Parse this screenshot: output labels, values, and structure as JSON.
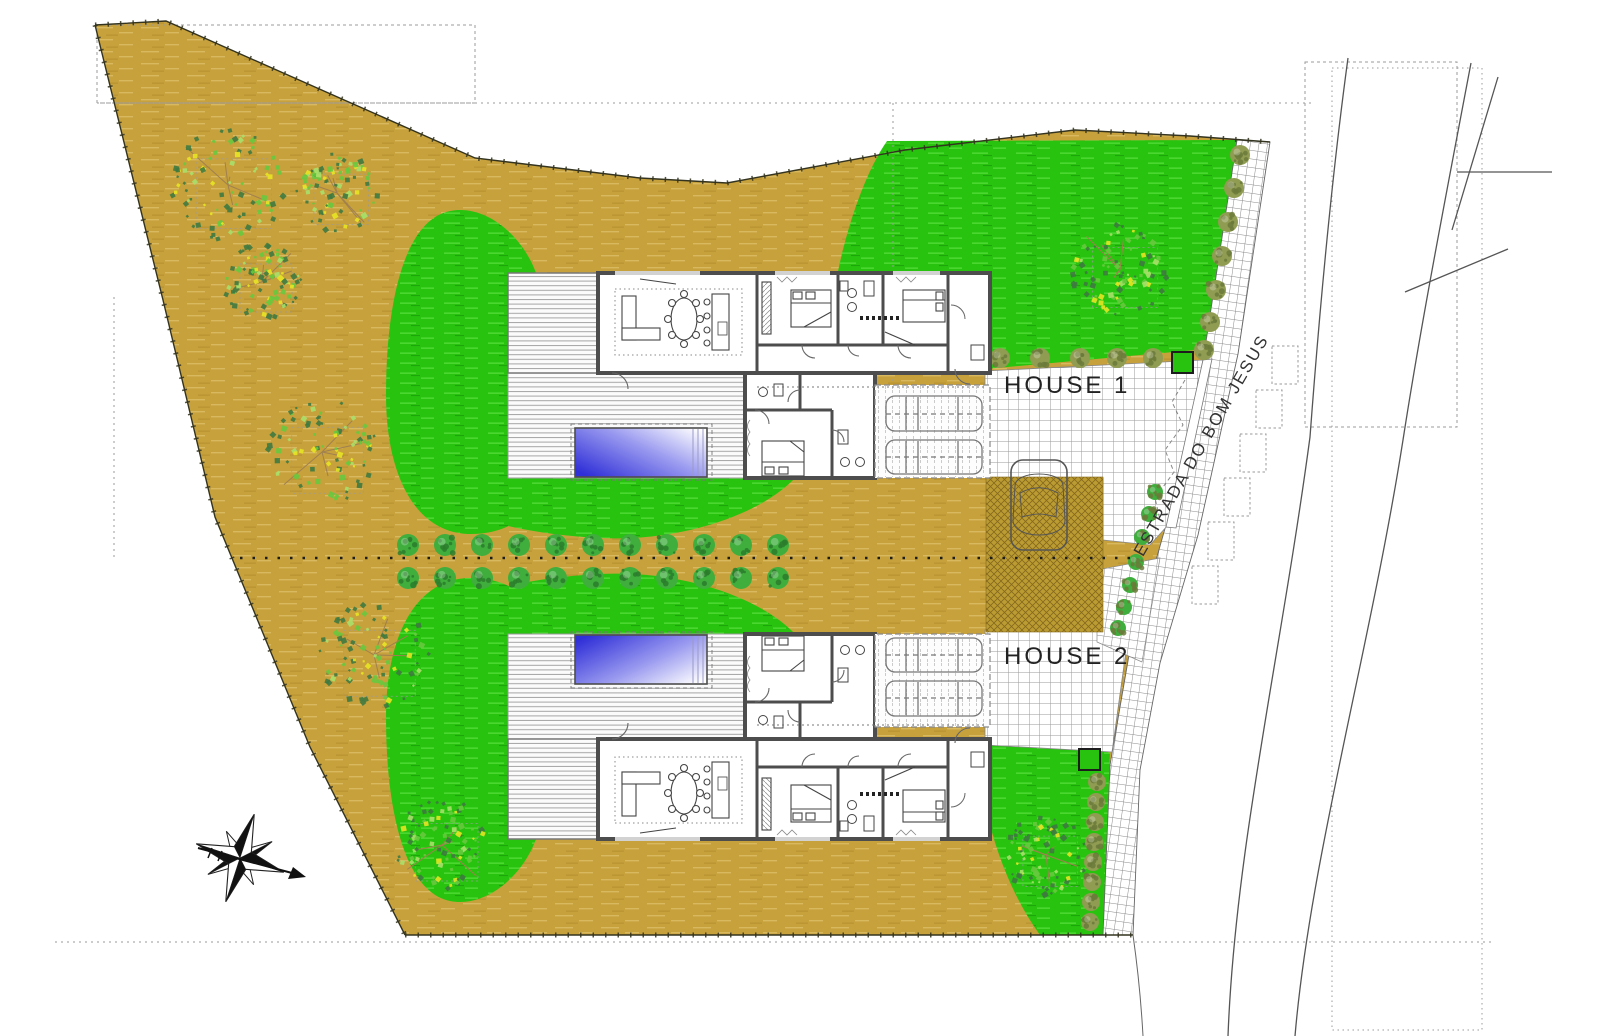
{
  "page": {
    "width": 1600,
    "height": 1036,
    "background": "#ffffff",
    "type": "architectural site plan drawing"
  },
  "plan": {
    "labels": {
      "house1": "HOUSE 1",
      "house2": "HOUSE 2",
      "street": "ESTRADA DO BOM JESUS"
    },
    "colors": {
      "ground": "#c7a13c",
      "ground_streak": "#d8b95f",
      "lawn": "#27c30f",
      "lawn_streak": "#55dc38",
      "pool_deep": "#3030d8",
      "pool_pale": "#ffffff",
      "wall": "#4d4d4d",
      "paver_line": "#9a9a9a",
      "hatch_base": "#bb9c33",
      "hatch_line": "#86691c",
      "tree_dark": "#3f7a40",
      "tree_mid": "#67c93e",
      "tree_light": "#a8e06a",
      "tree_yellow": "#e8e424",
      "bush_olive": "#8f9c52",
      "bush_olive_dark": "#6b7a3a",
      "bush_green": "#3fae3d",
      "bush_green_dark": "#2c7d2b",
      "line": "#444444"
    },
    "landscape": {
      "large_trees": [
        {
          "cx": 228,
          "cy": 185,
          "r": 58
        },
        {
          "cx": 337,
          "cy": 193,
          "r": 42
        },
        {
          "cx": 262,
          "cy": 282,
          "r": 40
        },
        {
          "cx": 322,
          "cy": 452,
          "r": 55
        },
        {
          "cx": 374,
          "cy": 655,
          "r": 55
        },
        {
          "cx": 442,
          "cy": 845,
          "r": 48
        },
        {
          "cx": 1120,
          "cy": 270,
          "r": 50
        },
        {
          "cx": 1046,
          "cy": 855,
          "r": 42
        }
      ],
      "hedge_rows": {
        "ys": [
          545,
          578
        ],
        "xs": [
          408,
          445,
          482,
          519,
          556,
          593,
          630,
          667,
          704,
          741,
          778
        ]
      },
      "court_top_bushes": {
        "y": 358,
        "xs": [
          1000,
          1040,
          1080,
          1117,
          1153
        ]
      },
      "sidewalk_bushes_ne": [
        [
          1240,
          155
        ],
        [
          1234,
          188
        ],
        [
          1228,
          222
        ],
        [
          1222,
          256
        ],
        [
          1216,
          290
        ],
        [
          1210,
          322
        ],
        [
          1204,
          350
        ]
      ],
      "driveway_bushes": [
        [
          1155,
          492
        ],
        [
          1149,
          514
        ],
        [
          1142,
          537
        ],
        [
          1136,
          562
        ],
        [
          1130,
          585
        ],
        [
          1124,
          607
        ],
        [
          1118,
          628
        ]
      ],
      "sidewalk_bushes_se": [
        [
          1097,
          782
        ],
        [
          1096,
          802
        ],
        [
          1095,
          822
        ],
        [
          1094,
          842
        ],
        [
          1093,
          862
        ],
        [
          1092,
          882
        ],
        [
          1091,
          902
        ],
        [
          1090,
          922
        ]
      ],
      "planters": [
        {
          "x": 1172,
          "y": 352
        },
        {
          "x": 1079,
          "y": 749
        }
      ]
    },
    "houses": [
      {
        "id": "house-1",
        "label": "HOUSE 1",
        "garage_cars": 2,
        "pool": true
      },
      {
        "id": "house-2",
        "label": "HOUSE 2",
        "garage_cars": 2,
        "pool": true
      }
    ],
    "street_cars": 1,
    "compass": {
      "cx": 240,
      "cy": 858
    }
  }
}
